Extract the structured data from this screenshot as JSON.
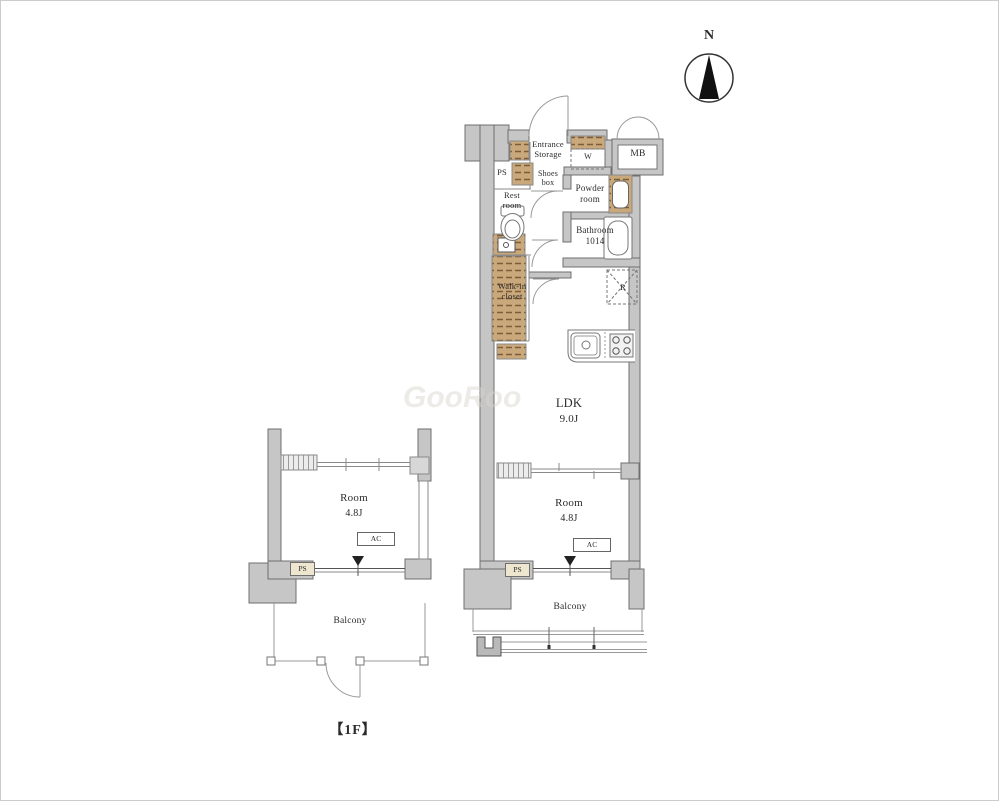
{
  "meta": {
    "type": "apartment-floor-plan"
  },
  "compass": {
    "label": "N"
  },
  "watermark": "GooRoo",
  "labels": {
    "entrance_storage": "Entrance\nStorage",
    "ps_top": "PS",
    "shoes_box": "Shoes\nbox",
    "rest_room": "Rest\nroom",
    "powder_room": "Powder\nroom",
    "washer": "W",
    "meter_box": "MB",
    "bathroom": "Bathroom\n1014",
    "walk_in_closet": "Walk-in\ncloset",
    "fridge": "R",
    "ldk": "LDK",
    "ldk_size": "9.0J",
    "room_right": "Room",
    "room_right_size": "4.8J",
    "ac_right": "AC",
    "ps_bottom_right": "PS",
    "balcony_right": "Balcony",
    "room_left": "Room",
    "room_left_size": "4.8J",
    "ac_left": "AC",
    "ps_bottom_left": "PS",
    "balcony_left": "Balcony",
    "floor": "【1F】"
  },
  "colors": {
    "wall_fill": "#c6c6c6",
    "wall_stroke": "#6f6f6f",
    "shelf_fill": "#c9a87b",
    "shelf_dash": "#7d5c38",
    "thin_line": "#8a8a8a",
    "text": "#2b2b2b",
    "needle": "#111111"
  }
}
